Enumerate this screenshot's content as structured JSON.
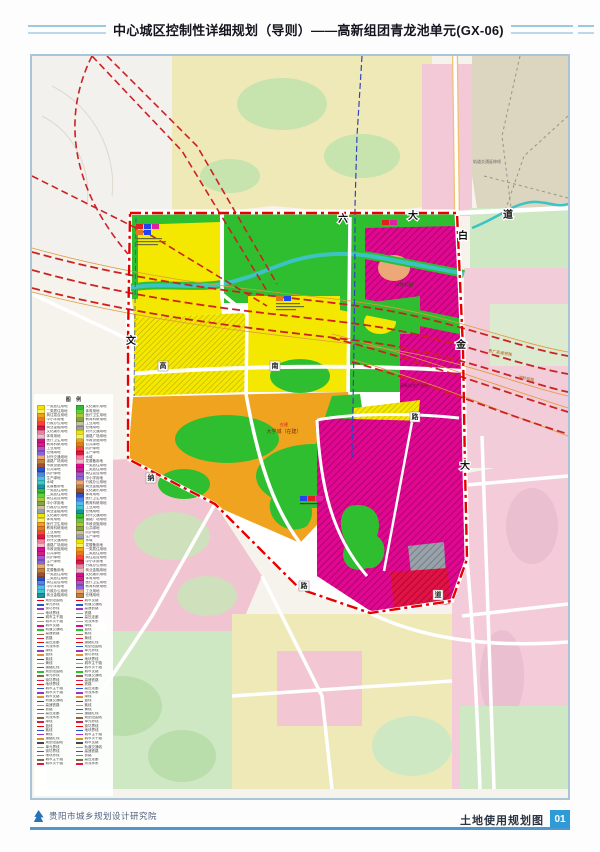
{
  "header": {
    "title": "中心城区控制性详细规划（导则）——高新组团青龙池单元(GX-06)"
  },
  "footer": {
    "institute": "贵阳市城乡规划设计研究院",
    "map_name": "土地使用规划图",
    "page_number": "01"
  },
  "map": {
    "road_names": {
      "top": [
        "六",
        "大",
        "道"
      ],
      "right": [
        "白",
        "金",
        "大"
      ],
      "left": "文",
      "plates": [
        "高",
        "南",
        "纳",
        "路",
        "路",
        "道"
      ]
    },
    "labels": {
      "rail_transit": "轨道交通延伸线",
      "hsr1": "贵广高速铁路",
      "hsr2": "湘黔铁路",
      "park": "山体公园",
      "university_tag": "在建",
      "university": "大学城（在建）",
      "industry": "高新技术产业园"
    }
  },
  "colors": {
    "boundary_red": "#e60000",
    "railway_red": "#cc2222",
    "railway_orange": "#e09a3a",
    "metro_blue": "#3344bb",
    "residential_yellow": "#f4e800",
    "education_orange": "#f0a31e",
    "park_green": "#2fbe2f",
    "industry_magenta": "#e00890",
    "commercial_crimson": "#e01345",
    "gray_zone": "#99a1a9",
    "river_teal": "#3cc3c3",
    "salmon": "#eda878",
    "pale_pink": "#f3c8d7",
    "pink_mid": "#f0aac6",
    "pale_green": "#cfe8c4",
    "pale_yellow": "#efe9b8",
    "beige": "#dcd5c0",
    "road_white": "#ffffff",
    "accent_blue": "#2e9bd6"
  },
  "legend": {
    "title": "图 例",
    "rows_per_column": 46,
    "symbol_rows_per_column": 40,
    "swatch_palette": [
      "#f2e400",
      "#f7ef60",
      "#f0a01c",
      "#e87820",
      "#ff4040",
      "#e01345",
      "#f080a0",
      "#f3b8cc",
      "#e00890",
      "#cc2288",
      "#aa55cc",
      "#8866dd",
      "#eda878",
      "#c08040",
      "#a05030",
      "#2a52cc",
      "#4f86e8",
      "#58b8ea",
      "#38c8c8",
      "#2090a0",
      "#2fbe2f",
      "#66cc44",
      "#a8c838",
      "#88a048",
      "#c8c0a0",
      "#98a2ae"
    ],
    "label_cycle": [
      "一类居住用地",
      "二类居住用地",
      "商住混合用地",
      "中小学用地",
      "行政办公用地",
      "商业金融用地",
      "文化娱乐用地",
      "体育用地",
      "医疗卫生用地",
      "教育科研用地",
      "工业用地",
      "仓储用地",
      "对外交通用地",
      "道路广场用地",
      "市政设施用地",
      "公共绿地",
      "防护绿地",
      "生产绿地",
      "水域",
      "发展备用地"
    ],
    "symbol_palette": [
      "#e60000",
      "#2a52cc",
      "#9933cc",
      "#e09030",
      "#444444",
      "#38c8c8",
      "#e00890",
      "#2fbe2f",
      "#886644",
      "#e01345"
    ],
    "symbol_label_cycle": [
      "规划范围线",
      "单元界线",
      "街坊界线",
      "地块界线",
      "城市主干路",
      "城市次干路",
      "城市支路",
      "轨道交通线",
      "高速铁路",
      "铁路",
      "高压走廊",
      "河流水系",
      "绿线",
      "蓝线",
      "紫线",
      "黄线",
      "道路红线"
    ]
  }
}
